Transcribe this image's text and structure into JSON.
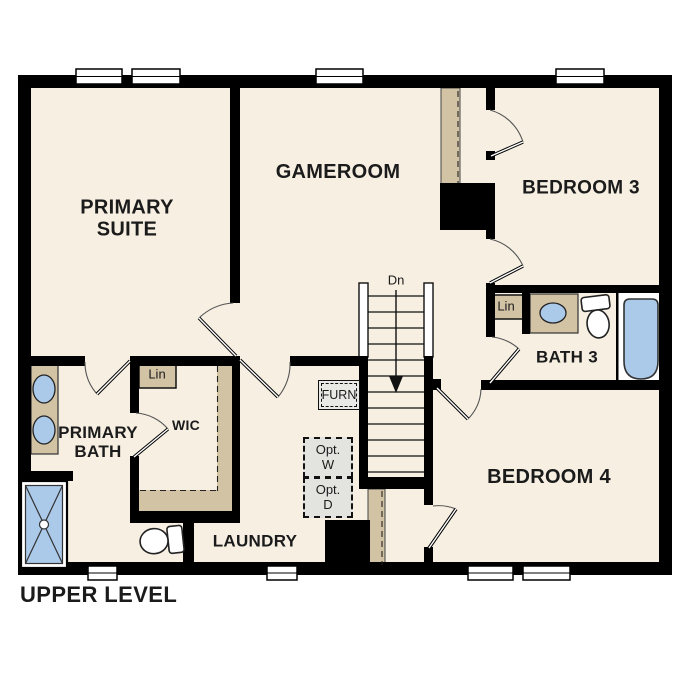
{
  "title": {
    "label": "UPPER LEVEL"
  },
  "rooms": {
    "primary_suite": {
      "line1": "PRIMARY",
      "line2": "SUITE"
    },
    "gameroom": {
      "label": "GAMEROOM"
    },
    "bedroom3": {
      "label": "BEDROOM 3"
    },
    "bath3": {
      "label": "BATH 3"
    },
    "bedroom4": {
      "label": "BEDROOM 4"
    },
    "primary_bath": {
      "line1": "PRIMARY",
      "line2": "BATH"
    },
    "wic": {
      "label": "WIC"
    },
    "laundry": {
      "label": "LAUNDRY"
    }
  },
  "annotations": {
    "stair_direction": "Dn",
    "linen_primary": "Lin",
    "linen_bath3": "Lin",
    "furnace": "FURN",
    "opt_washer_line1": "Opt.",
    "opt_washer_line2": "W",
    "opt_dryer_line1": "Opt.",
    "opt_dryer_line2": "D"
  },
  "colors": {
    "background": "#ffffff",
    "floor": "#f6efe2",
    "wall": "#000000",
    "casework_tan": "#d2c3a5",
    "fixture_blue": "#abc9e9",
    "optional_grey": "#e3e3e0",
    "text": "#1b1b1b"
  }
}
